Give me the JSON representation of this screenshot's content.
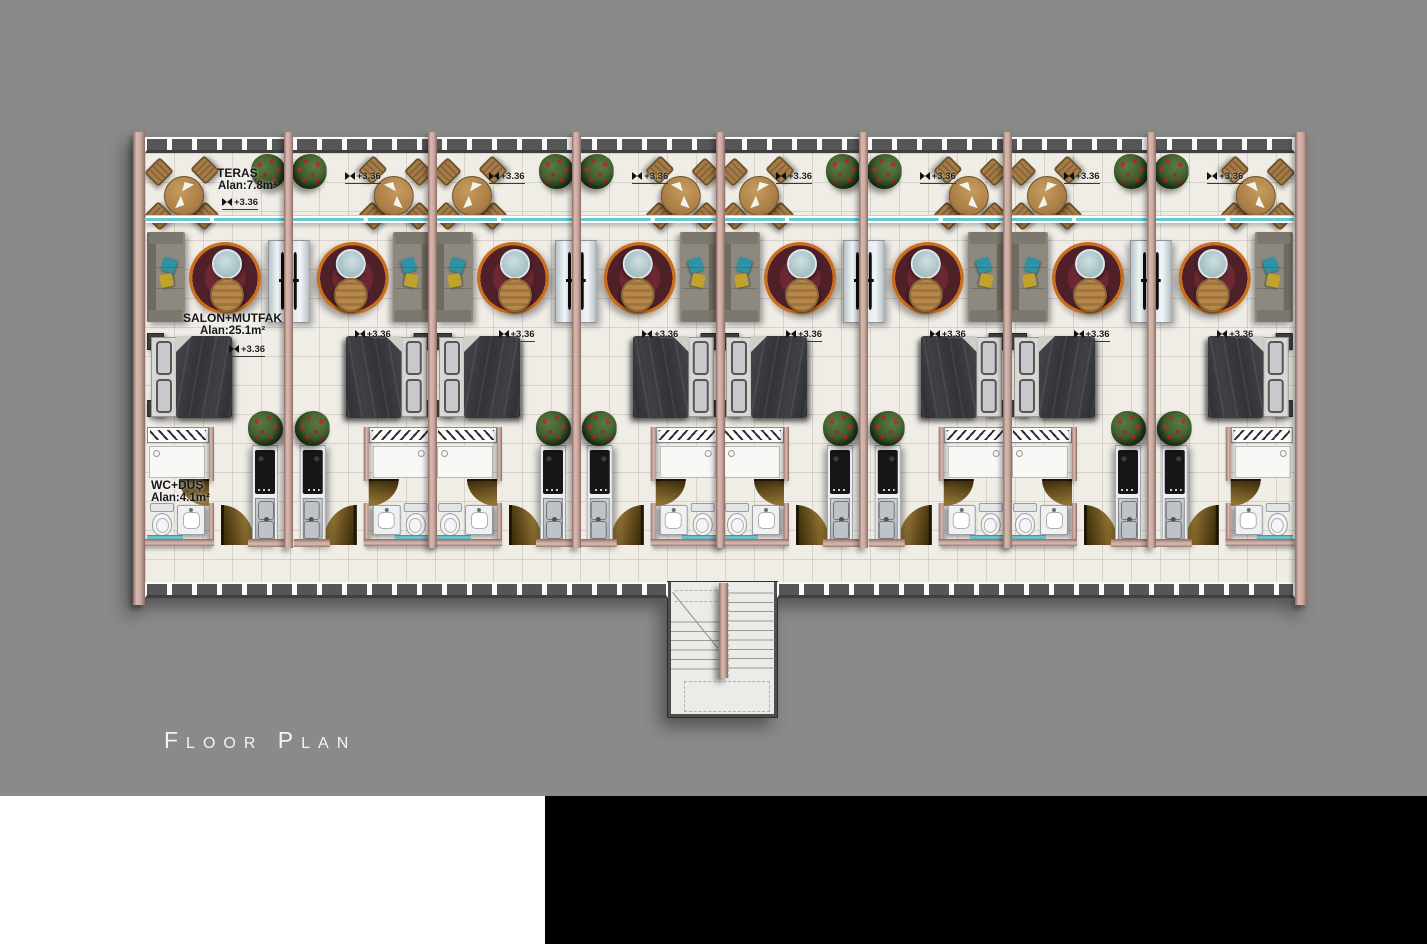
{
  "title": {
    "text": "Floor Plan"
  },
  "level_marker": "+3.36",
  "rooms": {
    "teras": {
      "name": "TERAS",
      "area": "Alan:7.8m²"
    },
    "salon": {
      "name": "SALON+MUTFAK",
      "area": "Alan:25.1m²"
    },
    "wc": {
      "name": "WC+DUŞ",
      "area": "Alan:4.1m²"
    }
  },
  "units": [
    {
      "id": 1,
      "mirrored": false,
      "labeled": true,
      "show_terrace_marker": false,
      "show_salon_marker": false
    },
    {
      "id": 2,
      "mirrored": true,
      "labeled": false,
      "show_terrace_marker": true,
      "show_salon_marker": true
    },
    {
      "id": 3,
      "mirrored": false,
      "labeled": false,
      "show_terrace_marker": true,
      "show_salon_marker": true
    },
    {
      "id": 4,
      "mirrored": true,
      "labeled": false,
      "show_terrace_marker": true,
      "show_salon_marker": true
    },
    {
      "id": 5,
      "mirrored": false,
      "labeled": false,
      "show_terrace_marker": true,
      "show_salon_marker": true
    },
    {
      "id": 6,
      "mirrored": true,
      "labeled": false,
      "show_terrace_marker": true,
      "show_salon_marker": true
    },
    {
      "id": 7,
      "mirrored": false,
      "labeled": false,
      "show_terrace_marker": true,
      "show_salon_marker": true
    },
    {
      "id": 8,
      "mirrored": true,
      "labeled": false,
      "show_terrace_marker": true,
      "show_salon_marker": true
    }
  ],
  "stairs": {
    "location": "bottom-center",
    "flights": 2
  },
  "colors": {
    "background": "#8a8a8a",
    "footer_left": "#ffffff",
    "footer_right": "#000000",
    "wall_pink": "#c9a8a0",
    "floor": "#f0ede7",
    "glass_teal": "#68c8d2",
    "rug_orange": "#e0862a",
    "rug_maroon": "#5e2530",
    "door_swing_brown": "#6b5220",
    "railing_dark": "#565656",
    "title_text": "#f4f4f2"
  }
}
